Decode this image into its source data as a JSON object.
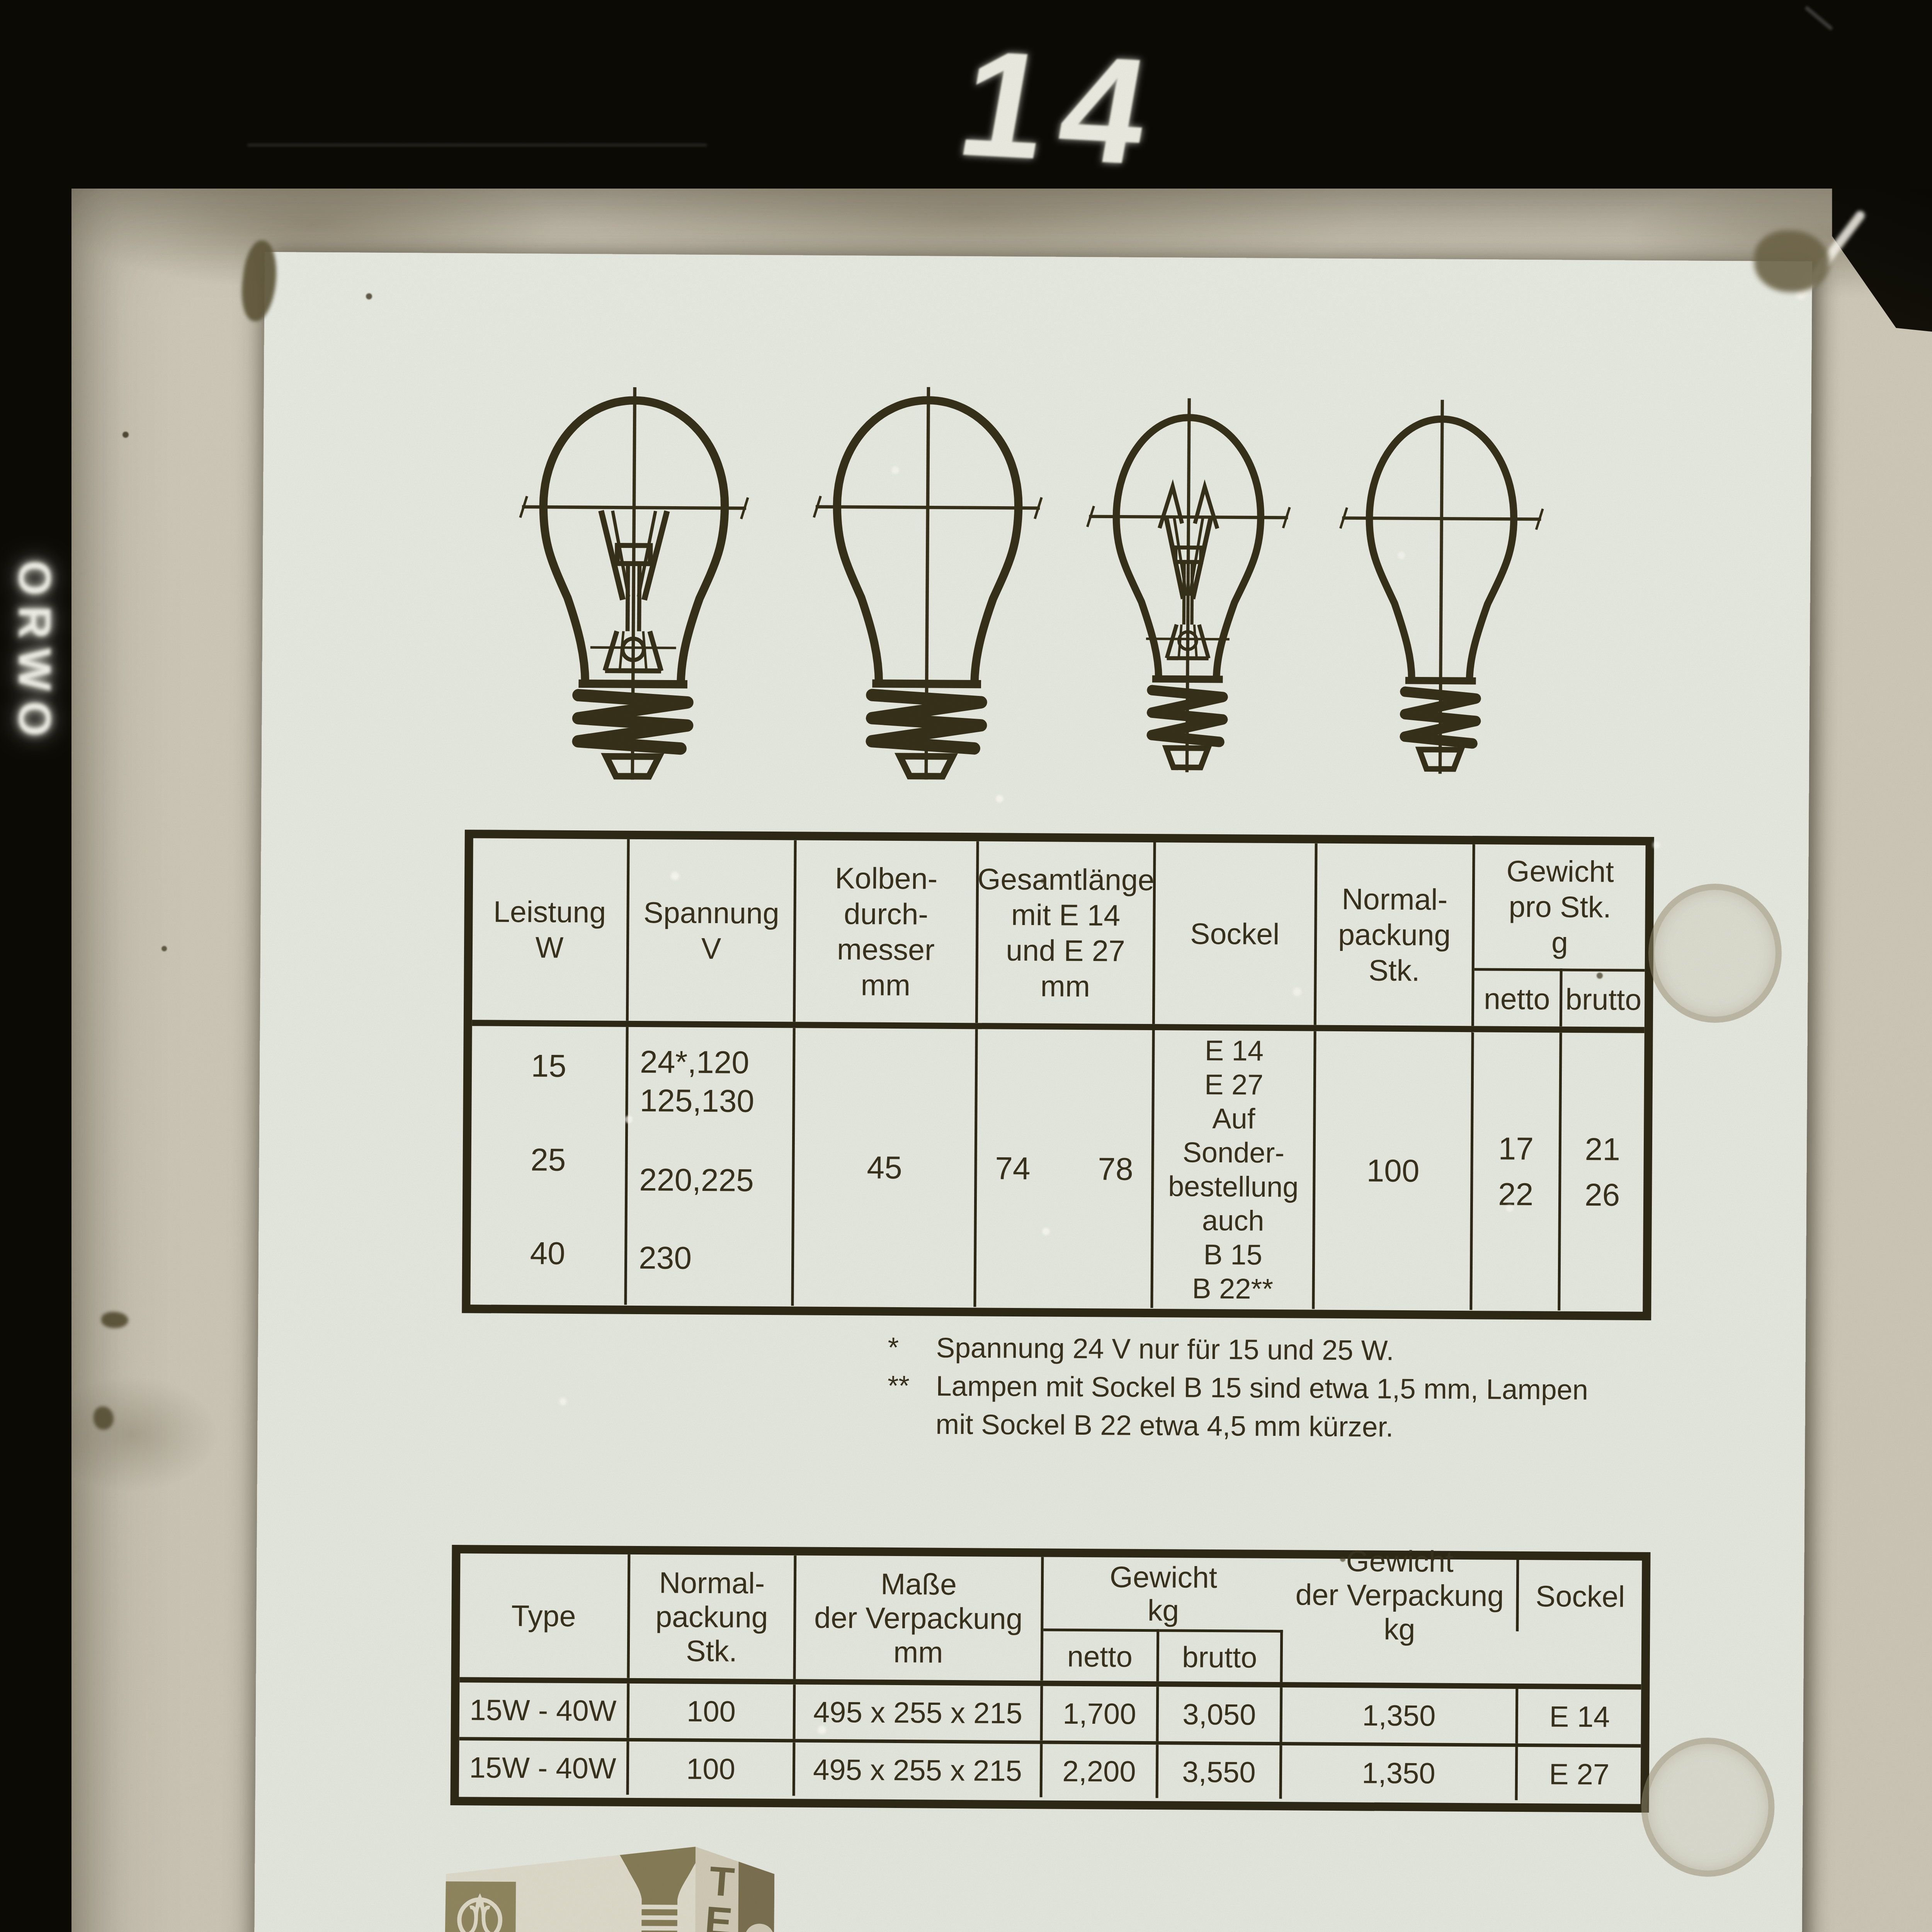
{
  "film": {
    "stock_brand": "ORWO",
    "frame_number": "14",
    "archive_number": "70/12599"
  },
  "figures": {
    "bulb_drawings": [
      "e27-bulb-with-filament",
      "e27-bulb-outline",
      "e14-bulb-with-filament",
      "e14-bulb-outline"
    ]
  },
  "spec_table": {
    "headers": {
      "leistung": [
        "Leistung",
        "W"
      ],
      "spannung": [
        "Spannung",
        "V"
      ],
      "kolben": [
        "Kolben-",
        "durch-",
        "messer",
        "mm"
      ],
      "gesamtlaenge": [
        "Gesamtl\u00e4nge",
        "mit E 14",
        "und E 27",
        "mm"
      ],
      "sockel": "Sockel",
      "normalpackung": [
        "Normal-",
        "packung",
        "Stk."
      ],
      "gewicht": [
        "Gewicht",
        "pro Stk.",
        "g"
      ],
      "netto": "netto",
      "brutto": "brutto"
    },
    "body": {
      "leistung": [
        "15",
        "25",
        "40"
      ],
      "spannung_top": [
        "24*,120",
        "125,130"
      ],
      "spannung_mid": "220,225",
      "spannung_bottom": "230",
      "kolben": "45",
      "gesamtlaenge": [
        "74",
        "78"
      ],
      "sockel": [
        "E 14",
        "E 27",
        "Auf",
        "Sonder-",
        "bestellung",
        "auch",
        "B 15",
        "B 22**"
      ],
      "normalpackung": "100",
      "netto": [
        "17",
        "22"
      ],
      "brutto": [
        "21",
        "26"
      ]
    }
  },
  "footnotes": {
    "rows": [
      {
        "marker": "*",
        "text": "Spannung 24 V nur f\u00fcr 15 und 25 W."
      },
      {
        "marker": "**",
        "text": "Lampen mit Sockel B 15 sind etwa 1,5 mm, Lampen"
      },
      {
        "marker": "",
        "text": "mit Sockel B 22 etwa 4,5 mm k\u00fcrzer."
      }
    ]
  },
  "packing_table": {
    "headers": {
      "type": "Type",
      "normalpackung": [
        "Normal-",
        "packung",
        "Stk."
      ],
      "masse": [
        "Ma\u00dfe",
        "der Verpackung",
        "mm"
      ],
      "gewicht": [
        "Gewicht",
        "kg"
      ],
      "netto": "netto",
      "brutto": "brutto",
      "gewicht_verpackung": [
        "Gewicht",
        "der Verpackung",
        "kg"
      ],
      "sockel": "Sockel"
    },
    "rows": [
      {
        "type": "15W - 40W",
        "pack": "100",
        "masse": "495 x 255 x 215",
        "netto": "1,700",
        "brutto": "3,050",
        "verpackung": "1,350",
        "sockel": "E 14"
      },
      {
        "type": "15W - 40W",
        "pack": "100",
        "masse": "495 x 255 x 215",
        "netto": "2,200",
        "brutto": "3,550",
        "verpackung": "1,350",
        "sockel": "E 27"
      }
    ]
  },
  "product": {
    "heading": "Illuminationslampen",
    "description": [
      "sind klar oder innen mattiert und sind f\u00fcr zus\u00e4tzliche",
      "Beleuchtung in Dekorationsleuchten in Wohnungen, f\u00fcr",
      "Leselampen, zur Beleuchtung von Schaufenstern und",
      "f\u00fcr verschiedene Reklamezwecke bestimmt."
    ]
  },
  "packaging_box": {
    "brand": "TESLA"
  },
  "colors": {
    "film_black": "#0b0a05",
    "paper": "#cdc7b8",
    "card": "#e6e9e1",
    "ink": "#37311c",
    "khaki": "#8f8660",
    "white_ink": "#f0efe8"
  }
}
